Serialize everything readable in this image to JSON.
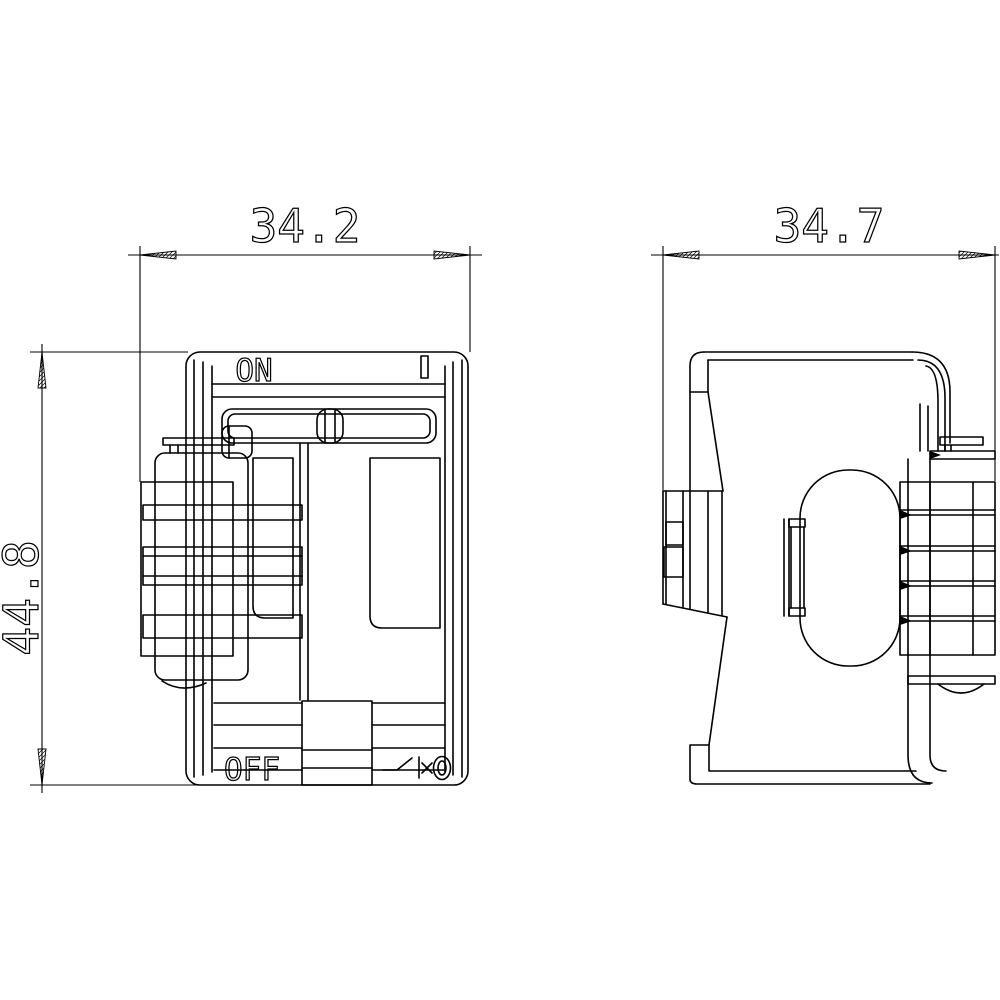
{
  "page": {
    "background": "#ffffff",
    "ink_color": "#000000",
    "type": "technical-dimension-drawing"
  },
  "dimensions": [
    {
      "id": "front_width",
      "label": "34.2",
      "orientation": "horizontal",
      "applies_to": "front-view"
    },
    {
      "id": "side_width",
      "label": "34.7",
      "orientation": "horizontal",
      "applies_to": "side-view"
    },
    {
      "id": "overall_height",
      "label": "44.8",
      "orientation": "vertical",
      "applies_to": "front-view"
    }
  ],
  "front_view": {
    "name": "front-view",
    "top_label": "ON",
    "top_symbol": "I",
    "bottom_label": "OFF",
    "bottom_symbol_icon": "switch-disconnector-icon"
  },
  "side_view": {
    "name": "side-view"
  },
  "icons": {
    "arrowheads": "hatched-dimension-arrow-icon",
    "hatch": "brick-hatch-pattern"
  }
}
